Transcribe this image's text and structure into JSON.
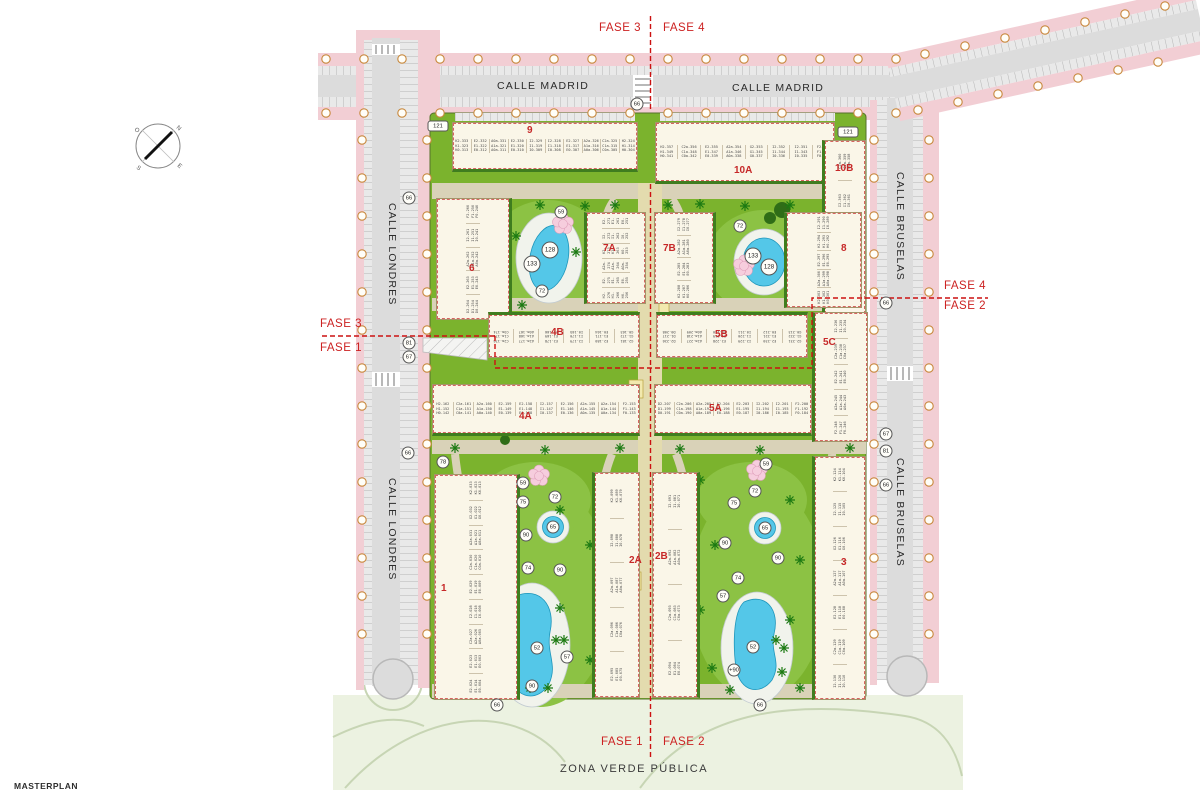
{
  "title": "MASTERPLAN",
  "compass": {
    "n": "N",
    "s": "S",
    "e": "E",
    "w": "O"
  },
  "streets": {
    "madrid_left": "CALLE MADRID",
    "madrid_right": "CALLE MADRID",
    "londres_upper": "CALLE LONDRES",
    "londres_lower": "CALLE LONDRES",
    "bruselas_upper": "CALLE BRUSELAS",
    "bruselas_lower": "CALLE BRUSELAS",
    "zona_verde": "ZONA VERDE PÚBLICA"
  },
  "phases": {
    "top_left": "FASE 3",
    "top_right": "FASE 4",
    "left_above": "FASE 3",
    "left_below": "FASE 1",
    "right_above": "FASE 4",
    "right_below": "FASE 2",
    "bottom_left": "FASE 1",
    "bottom_right": "FASE 2"
  },
  "buildings": [
    {
      "id": "9",
      "label": "9",
      "x": 452,
      "y": 122,
      "w": 186,
      "h": 50,
      "dir": "h",
      "lx": 74,
      "ly": 2,
      "hedge": "b",
      "units": [
        "K2-333 K1-323 K0-313",
        "E2-332 E1-322 E0-312",
        "A0a-331 A1a-321 A0a-311",
        "E2-330 E1-320 E0-310",
        "I2-329 I1-319 I0-309",
        "I2-328 I1-318 I0-308",
        "E2-327 E1-317 E0-307",
        "A2a-326 A1a-316 A0a-306",
        "C2a-325 C1a-315 C0a-305",
        "H2-324 H1-314 H0-304"
      ]
    },
    {
      "id": "10A",
      "label": "10A",
      "x": 655,
      "y": 122,
      "w": 180,
      "h": 62,
      "dir": "h",
      "lx": 78,
      "ly": 42,
      "hedge": "b",
      "units": [
        "H2-357 H1-349 H0-341",
        "C2a-356 C1a-348 C0a-342",
        "E2-355 E1-347 E0-339",
        "A2a-354 A1a-346 A0a-338",
        "G2-353 G1-345 G0-337",
        "I2-352 I1-344 I0-336",
        "I2-351 I1-343 I0-335",
        "F2-350 F1-342 F0-334"
      ]
    },
    {
      "id": "10B",
      "label": "10B",
      "x": 822,
      "y": 140,
      "w": 44,
      "h": 200,
      "dir": "v",
      "lx": 10,
      "ly": 22,
      "hedge": "l",
      "units": [
        "K2-372 K1-371 K0-370",
        "E2-369 E1-368 E0-367",
        "A2a-366 A1a-365 A0a-364",
        "I2-363 I1-362 I0-361",
        "C2a-360 C1a-359 C0a-358"
      ]
    },
    {
      "id": "6",
      "label": "6",
      "x": 436,
      "y": 198,
      "w": 76,
      "h": 122,
      "dir": "v",
      "lx": 32,
      "ly": 64,
      "hedge": "r",
      "units": [
        "D2-264 D1-254 D0-244",
        "E2-263 E1-253 E0-243",
        "A2a-262 A1a-252 A0a-242",
        "I2-261 I1-251 I0-241",
        "F2-260 F1-250 F0-240"
      ]
    },
    {
      "id": "7A",
      "label": "7A",
      "x": 584,
      "y": 212,
      "w": 62,
      "h": 92,
      "dir": "v",
      "lx": 16,
      "ly": 30,
      "hedge": "l",
      "units": [
        "H2-276 H1-266 H0-256",
        "E2-275 E1-265 E0-255",
        "A2a-274 A1a-264 A0a-254",
        "K2-273 K1-263 K0-253",
        "I2-272 I1-262 I0-252",
        "E2-271 E1-261 E0-251"
      ]
    },
    {
      "id": "7B",
      "label": "7B",
      "x": 654,
      "y": 212,
      "w": 62,
      "h": 92,
      "dir": "v",
      "lx": 8,
      "ly": 30,
      "hedge": "r",
      "units": [
        "K2-288 K1-287 K0-286",
        "E2-285 E1-284 E0-283",
        "A2a-282 A1a-281 A0a-280",
        "I2-279 I1-278 I0-277"
      ]
    },
    {
      "id": "8",
      "label": "8",
      "x": 784,
      "y": 212,
      "w": 78,
      "h": 96,
      "dir": "v",
      "lx": 54,
      "ly": 30,
      "hedge": "l",
      "units": [
        "K2-303 K1-302 K0-301",
        "A2a-300 A1a-299 A0a-298",
        "E2-297 E1-296 E0-295",
        "H2-294 H1-293 H0-292",
        "I2-291 I1-290 I0-289"
      ]
    },
    {
      "id": "4B",
      "label": "4B",
      "x": 488,
      "y": 312,
      "w": 152,
      "h": 46,
      "dir": "hr",
      "lx": 62,
      "ly": 12,
      "hedge": "t",
      "units": [
        "G2-181 G1-172 G0-163",
        "E2-180 E1-171 E0-164",
        "I2-179 I1-170 I0-165",
        "E2-178 E1-169 E0-166",
        "A2a-177 A1a-168 A0a-167",
        "C2a-176 C1a-175 C0a-174"
      ]
    },
    {
      "id": "5B",
      "label": "5B",
      "x": 656,
      "y": 312,
      "w": 152,
      "h": 46,
      "dir": "hr",
      "lx": 58,
      "ly": 14,
      "hedge": "t",
      "units": [
        "G2-231 G1-222 G0-213",
        "E2-230 E1-221 E0-212",
        "I2-229 I1-220 I0-211",
        "E2-228 E1-219 E0-210",
        "A2a-227 A1a-218 A0a-209",
        "D2-226 D1-217 D0-208"
      ]
    },
    {
      "id": "5C",
      "label": "5C",
      "x": 812,
      "y": 312,
      "w": 56,
      "h": 130,
      "dir": "v",
      "lx": 8,
      "ly": 24,
      "hedge": "l",
      "units": [
        "F2-248 F1-247 F0-246",
        "A2a-245 A1a-244 A0a-243",
        "E2-242 E1-241 E0-240",
        "C2a-239 C1a-238 C0a-237",
        "I2-236 I1-235 I0-234"
      ]
    },
    {
      "id": "4A",
      "label": "4A",
      "x": 432,
      "y": 384,
      "w": 208,
      "h": 52,
      "dir": "h",
      "lx": 86,
      "ly": 26,
      "hedge": "b",
      "units": [
        "H2-162 H1-152 H0-142",
        "C2a-161 C1a-151 C0a-141",
        "A2a-160 A1a-150 A0a-140",
        "E2-159 E1-149 E0-139",
        "E2-158 E1-148 E0-138",
        "I2-157 I1-147 I0-137",
        "E2-156 E1-146 E0-136",
        "A2a-155 A1a-145 A0a-135",
        "A2a-154 A1a-144 A0a-134",
        "F2-153 F1-143 F0-133"
      ]
    },
    {
      "id": "5A",
      "label": "5A",
      "x": 654,
      "y": 384,
      "w": 158,
      "h": 52,
      "dir": "h",
      "lx": 54,
      "ly": 18,
      "hedge": "b",
      "units": [
        "D2-207 D1-199 D0-191",
        "C2a-206 C1a-198 C0a-190",
        "A2a-205 A1a-197 A0a-189",
        "E2-204 E1-196 E0-188",
        "E2-203 E1-195 E0-187",
        "I2-202 I1-194 I0-186",
        "I2-201 I1-193 I0-185",
        "F2-200 F1-192 F0-184"
      ]
    },
    {
      "id": "1",
      "label": "1",
      "x": 434,
      "y": 474,
      "w": 86,
      "h": 226,
      "dir": "v",
      "lx": 6,
      "ly": 108,
      "hedge": "r",
      "units": [
        "E2-024 E1-014 E0-004",
        "E2-023 E1-013 E0-003",
        "C2a-027 A2a-026 A0a-005",
        "I2-028 I1-018 I0-008",
        "E2-029 E1-019 E0-009",
        "C2a-030 C1a-020 C0a-010",
        "A2a-031 A1a-021 A0a-011",
        "G2-032 G1-022 G0-012",
        "K2-033 K1-023 K0-013"
      ]
    },
    {
      "id": "2A",
      "label": "2A",
      "x": 592,
      "y": 472,
      "w": 48,
      "h": 226,
      "dir": "v",
      "lx": 34,
      "ly": 82,
      "hedge": "l",
      "units": [
        "E2-095 E1-085 E0-075",
        "C2a-096 C1a-086 C0a-076",
        "A2a-097 A1a-087 A0a-077",
        "I2-098 I1-088 I0-078",
        "K2-099 K1-089 K0-079"
      ]
    },
    {
      "id": "2B",
      "label": "2B",
      "x": 652,
      "y": 472,
      "w": 48,
      "h": 226,
      "dir": "v",
      "lx": 2,
      "ly": 78,
      "hedge": "r",
      "units": [
        "E2-094 E1-084 E0-074",
        "C2a-093 C1a-083 C0a-073",
        "A2a-092 A1a-082 A0a-072",
        "I2-091 I1-081 I0-071"
      ]
    },
    {
      "id": "3",
      "label": "3",
      "x": 812,
      "y": 456,
      "w": 54,
      "h": 244,
      "dir": "v",
      "lx": 26,
      "ly": 100,
      "hedge": "l",
      "units": [
        "I2-130 I1-120 I0-110",
        "C2a-129 C1a-119 C0a-109",
        "E2-128 E1-118 E0-108",
        "A2a-127 A1a-117 A0a-107",
        "G2-126 G1-116 G0-106",
        "I2-125 I1-115 I0-105",
        "K2-124 K1-114 K0-104"
      ]
    }
  ],
  "markers": [
    {
      "v": "121",
      "x": 438,
      "y": 126
    },
    {
      "v": "121",
      "x": 848,
      "y": 132
    },
    {
      "v": "66",
      "x": 637,
      "y": 104
    },
    {
      "v": "66",
      "x": 409,
      "y": 198
    },
    {
      "v": "66",
      "x": 408,
      "y": 453
    },
    {
      "v": "66",
      "x": 886,
      "y": 303
    },
    {
      "v": "66",
      "x": 886,
      "y": 485
    },
    {
      "v": "66",
      "x": 497,
      "y": 705
    },
    {
      "v": "66",
      "x": 760,
      "y": 705
    },
    {
      "v": "81",
      "x": 409,
      "y": 343
    },
    {
      "v": "67",
      "x": 409,
      "y": 357
    },
    {
      "v": "67",
      "x": 886,
      "y": 434
    },
    {
      "v": "81",
      "x": 886,
      "y": 451
    },
    {
      "v": "78",
      "x": 443,
      "y": 462
    },
    {
      "v": "59",
      "x": 561,
      "y": 212
    },
    {
      "v": "59",
      "x": 523,
      "y": 483
    },
    {
      "v": "59",
      "x": 766,
      "y": 464
    },
    {
      "v": "128",
      "x": 550,
      "y": 250
    },
    {
      "v": "133",
      "x": 532,
      "y": 264
    },
    {
      "v": "133",
      "x": 753,
      "y": 256
    },
    {
      "v": "128",
      "x": 769,
      "y": 267
    },
    {
      "v": "72",
      "x": 542,
      "y": 291
    },
    {
      "v": "72",
      "x": 740,
      "y": 226
    },
    {
      "v": "72",
      "x": 555,
      "y": 497
    },
    {
      "v": "72",
      "x": 755,
      "y": 491
    },
    {
      "v": "75",
      "x": 523,
      "y": 502
    },
    {
      "v": "75",
      "x": 734,
      "y": 503
    },
    {
      "v": "65",
      "x": 553,
      "y": 527
    },
    {
      "v": "65",
      "x": 765,
      "y": 528
    },
    {
      "v": "90",
      "x": 526,
      "y": 535
    },
    {
      "v": "90",
      "x": 560,
      "y": 570
    },
    {
      "v": "90",
      "x": 725,
      "y": 543
    },
    {
      "v": "90",
      "x": 778,
      "y": 558
    },
    {
      "v": "90",
      "x": 532,
      "y": 686
    },
    {
      "v": "74",
      "x": 528,
      "y": 568
    },
    {
      "v": "74",
      "x": 738,
      "y": 578
    },
    {
      "v": "57",
      "x": 567,
      "y": 657
    },
    {
      "v": "57",
      "x": 723,
      "y": 596
    },
    {
      "v": "52",
      "x": 537,
      "y": 648
    },
    {
      "v": "52",
      "x": 753,
      "y": 647
    },
    {
      "v": "+90",
      "x": 734,
      "y": 670
    }
  ]
}
